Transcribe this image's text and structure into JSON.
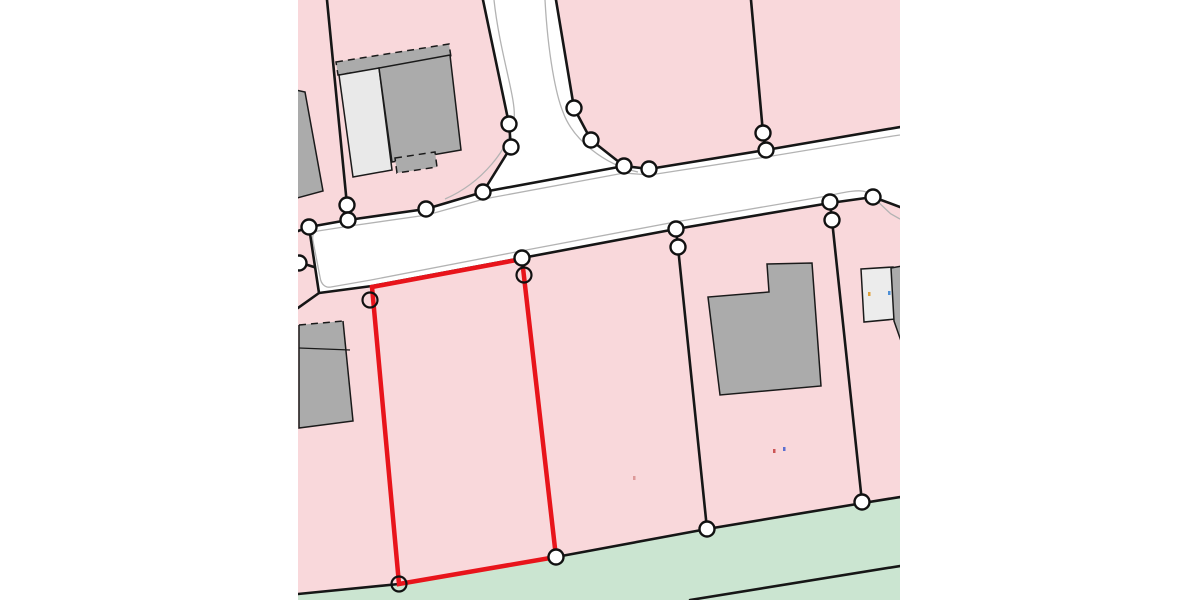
{
  "map": {
    "description": "cadastral-parcel-map",
    "viewport": {
      "x": 298,
      "y": 0,
      "width": 602,
      "height": 600,
      "canvas_width": 1200,
      "canvas_height": 600
    },
    "colors": {
      "margin": "#ffffff",
      "parcel_pink": "#f9d8db",
      "green_area": "#cbe5d1",
      "road_white": "#ffffff",
      "curb_gray": "#b3b3b3",
      "boundary_black": "#161616",
      "building_dark": "#ababab",
      "building_light": "#e9e9e9",
      "building_light2": "#ececec",
      "building_stroke": "#1a1a1a",
      "highlight_red": "#e8141b",
      "vertex_fill": "#ffffff",
      "vertex_stroke": "#111111"
    },
    "base": {
      "name": "parcel-area-base",
      "rect": [
        298,
        0,
        602,
        600
      ]
    },
    "green_polygons": [
      {
        "name": "green-strip",
        "points": [
          [
            298,
            594
          ],
          [
            399,
            584
          ],
          [
            556,
            557
          ],
          [
            707,
            529
          ],
          [
            863,
            503
          ],
          [
            900,
            497
          ],
          [
            900,
            600
          ],
          [
            298,
            600
          ]
        ]
      }
    ],
    "road": {
      "name": "road-surface",
      "points": [
        [
          483,
          0
        ],
        [
          509,
          124
        ],
        [
          511,
          147
        ],
        [
          483,
          192
        ],
        [
          426,
          209
        ],
        [
          348,
          220
        ],
        [
          309,
          227
        ],
        [
          319,
          293
        ],
        [
          372,
          286
        ],
        [
          522,
          258
        ],
        [
          676,
          229
        ],
        [
          830,
          203
        ],
        [
          873,
          197
        ],
        [
          900,
          207
        ],
        [
          900,
          127
        ],
        [
          766,
          150
        ],
        [
          649,
          169
        ],
        [
          624,
          166
        ],
        [
          591,
          140
        ],
        [
          574,
          108
        ],
        [
          556,
          0
        ]
      ]
    },
    "curbs": [
      {
        "name": "curb-top",
        "d": "M318,231 L350,226 L427,215 L484,199 L624,173 L650,175 L766,157 L893,136 L900,135"
      },
      {
        "name": "curb-junction-left",
        "d": "M494,0 C500,55 517,100 514,120 C510,148 482,183 445,199"
      },
      {
        "name": "curb-junction-right",
        "d": "M545,0 C548,55 556,95 563,112 C573,140 605,165 638,172"
      },
      {
        "name": "curb-bottom",
        "d": "M331,287 L371,280 L521,251 L675,222 L827,196 C845,192 860,189 866,192 C874,197 883,207 891,214 L900,219"
      },
      {
        "name": "curb-road-end",
        "d": "M318,231 C313,232 312,236 313,241 L320,277 C321,285 326,288 331,287"
      }
    ],
    "boundaries": [
      {
        "name": "boundary-upper-west",
        "points": [
          [
            327,
            0
          ],
          [
            347,
            205
          ],
          [
            348,
            220
          ]
        ]
      },
      {
        "name": "boundary-upper-east",
        "points": [
          [
            751,
            0
          ],
          [
            763,
            133
          ],
          [
            766,
            151
          ]
        ]
      },
      {
        "name": "road-edge-vertical-left",
        "points": [
          [
            483,
            0
          ],
          [
            509,
            124
          ],
          [
            511,
            147
          ],
          [
            483,
            192
          ]
        ]
      },
      {
        "name": "road-edge-vertical-right",
        "points": [
          [
            556,
            0
          ],
          [
            574,
            108
          ],
          [
            591,
            140
          ],
          [
            624,
            166
          ]
        ]
      },
      {
        "name": "road-edge-junction-cross",
        "points": [
          [
            483,
            192
          ],
          [
            624,
            166
          ],
          [
            649,
            169
          ]
        ]
      },
      {
        "name": "road-edge-top-west",
        "points": [
          [
            483,
            192
          ],
          [
            426,
            209
          ],
          [
            348,
            220
          ],
          [
            309,
            227
          ]
        ]
      },
      {
        "name": "road-edge-top-east",
        "points": [
          [
            649,
            169
          ],
          [
            766,
            150
          ],
          [
            900,
            127
          ]
        ]
      },
      {
        "name": "road-end-cap",
        "points": [
          [
            309,
            227
          ],
          [
            319,
            293
          ]
        ]
      },
      {
        "name": "road-end-stub-left",
        "points": [
          [
            309,
            227
          ],
          [
            298,
            231
          ]
        ]
      },
      {
        "name": "boundary-stub-west",
        "points": [
          [
            298,
            262
          ],
          [
            314,
            267
          ]
        ]
      },
      {
        "name": "road-edge-bottom",
        "points": [
          [
            298,
            308
          ],
          [
            319,
            293
          ],
          [
            372,
            286
          ],
          [
            522,
            258
          ],
          [
            676,
            229
          ],
          [
            830,
            203
          ],
          [
            873,
            197
          ],
          [
            900,
            207
          ]
        ]
      },
      {
        "name": "boundary-mid-south-1",
        "points": [
          [
            676,
            229
          ],
          [
            678,
            247
          ],
          [
            707,
            529
          ]
        ]
      },
      {
        "name": "boundary-mid-south-2",
        "points": [
          [
            830,
            202
          ],
          [
            832,
            220
          ],
          [
            862,
            502
          ]
        ]
      },
      {
        "name": "boundary-under-red-left",
        "points": [
          [
            372,
            286
          ],
          [
            399,
            584
          ]
        ]
      },
      {
        "name": "boundary-under-red-right",
        "points": [
          [
            522,
            258
          ],
          [
            556,
            557
          ]
        ]
      },
      {
        "name": "boundary-green-edge",
        "points": [
          [
            298,
            594
          ],
          [
            399,
            584
          ],
          [
            556,
            557
          ],
          [
            707,
            529
          ],
          [
            863,
            503
          ],
          [
            900,
            497
          ]
        ]
      },
      {
        "name": "boundary-green-inner",
        "points": [
          [
            690,
            600
          ],
          [
            900,
            566
          ]
        ]
      }
    ],
    "buildings": [
      {
        "name": "building-left-clipped-top",
        "points": [
          [
            286,
            88
          ],
          [
            305,
            92
          ],
          [
            323,
            191
          ],
          [
            286,
            201
          ]
        ],
        "fill": "dark"
      },
      {
        "name": "building-topleft-canopy-dashed",
        "points": [
          [
            336,
            62
          ],
          [
            449,
            44
          ],
          [
            451,
            57
          ],
          [
            338,
            75
          ]
        ],
        "fill": "dark",
        "dashed": true
      },
      {
        "name": "building-topleft-light-wing",
        "points": [
          [
            339,
            75
          ],
          [
            379,
            68
          ],
          [
            392,
            170
          ],
          [
            353,
            177
          ]
        ],
        "fill": "light"
      },
      {
        "name": "building-topleft-main",
        "points": [
          [
            379,
            68
          ],
          [
            450,
            55
          ],
          [
            461,
            150
          ],
          [
            392,
            162
          ]
        ],
        "fill": "dark"
      },
      {
        "name": "building-topleft-step",
        "points": [
          [
            395,
            158
          ],
          [
            435,
            152
          ],
          [
            437,
            167
          ],
          [
            397,
            173
          ]
        ],
        "fill": "dark",
        "dashed": true
      },
      {
        "name": "building-left-mid",
        "points": [
          [
            299,
            325
          ],
          [
            343,
            321
          ],
          [
            353,
            421
          ],
          [
            299,
            428
          ]
        ],
        "fill": "dark",
        "top_dashed": true,
        "divider": [
          [
            299,
            348
          ],
          [
            350,
            350
          ]
        ]
      },
      {
        "name": "building-l-shaped-mid",
        "points": [
          [
            767,
            264
          ],
          [
            812,
            263
          ],
          [
            821,
            386
          ],
          [
            720,
            395
          ],
          [
            708,
            297
          ],
          [
            769,
            292
          ]
        ],
        "fill": "dark"
      },
      {
        "name": "building-right-clipped-light",
        "points": [
          [
            861,
            269
          ],
          [
            893,
            267
          ],
          [
            896,
            319
          ],
          [
            864,
            322
          ]
        ],
        "fill": "light2"
      },
      {
        "name": "building-right-clipped-dark",
        "points": [
          [
            891,
            268
          ],
          [
            902,
            266
          ],
          [
            907,
            358
          ],
          [
            894,
            321
          ]
        ],
        "fill": "dark"
      }
    ],
    "highlight_parcel": {
      "name": "selected-parcel-outline",
      "points": [
        [
          372,
          287
        ],
        [
          522,
          259
        ],
        [
          556,
          557
        ],
        [
          399,
          584
        ]
      ],
      "stroke_width": 4.5
    },
    "vertices_filled": [
      [
        309,
        227
      ],
      [
        299,
        263
      ],
      [
        347,
        205
      ],
      [
        348,
        220
      ],
      [
        426,
        209
      ],
      [
        483,
        192
      ],
      [
        509,
        124
      ],
      [
        511,
        147
      ],
      [
        574,
        108
      ],
      [
        591,
        140
      ],
      [
        624,
        166
      ],
      [
        649,
        169
      ],
      [
        763,
        133
      ],
      [
        766,
        150
      ],
      [
        676,
        229
      ],
      [
        678,
        247
      ],
      [
        830,
        202
      ],
      [
        832,
        220
      ],
      [
        873,
        197
      ],
      [
        522,
        258
      ],
      [
        556,
        557
      ],
      [
        707,
        529
      ],
      [
        862,
        502
      ]
    ],
    "vertices_unfilled": [
      [
        370,
        300
      ],
      [
        524,
        275
      ],
      [
        399,
        584
      ]
    ],
    "vertex_radius": 7.5,
    "specks": [
      {
        "x": 868,
        "y": 292,
        "color": "#e0a23c"
      },
      {
        "x": 888,
        "y": 291,
        "color": "#4d8fd6"
      },
      {
        "x": 773,
        "y": 449,
        "color": "#cc5555"
      },
      {
        "x": 783,
        "y": 447,
        "color": "#5c6fd0"
      },
      {
        "x": 633,
        "y": 476,
        "color": "#dd9999"
      }
    ]
  }
}
